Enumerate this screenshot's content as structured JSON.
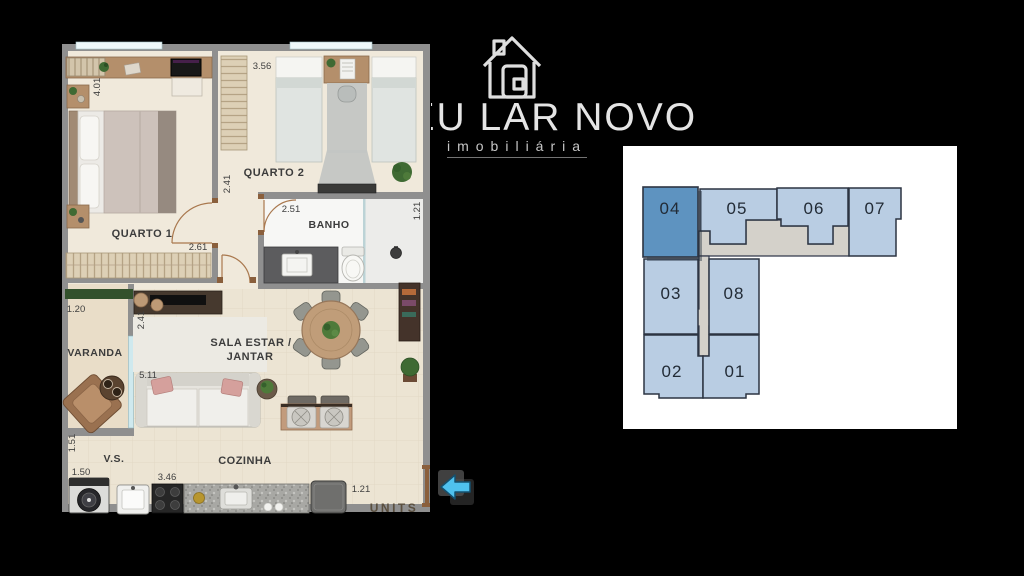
{
  "logo": {
    "name": "MEU LAR NOVO",
    "tagline": "imobiliária",
    "icon": "house-outline-icon"
  },
  "floorplan": {
    "rooms": {
      "quarto1": {
        "label": "QUARTO 1",
        "dim_height": "4.01",
        "dim_width": "2.61"
      },
      "quarto2": {
        "label": "QUARTO 2",
        "dim_width": "3.56"
      },
      "hall": {
        "dim_width": "2.41"
      },
      "banho": {
        "label": "BANHO",
        "dim_width": "2.51",
        "dim_height": "1.21"
      },
      "varanda": {
        "label": "VARANDA",
        "dim_width": "1.20"
      },
      "sala": {
        "label_line1": "SALA ESTAR /",
        "label_line2": "JANTAR",
        "dim_height": "2.41",
        "dim_width": "5.11"
      },
      "vs": {
        "label": "V.S.",
        "dim_height": "1.51",
        "dim_width": "1.50"
      },
      "cozinha": {
        "label": "COZINHA",
        "dim_width": "3.46",
        "dim_depth": "1.21"
      }
    },
    "watermark": "UNITS"
  },
  "unit_map": {
    "highlighted_unit": "04",
    "units": [
      {
        "number": "04",
        "highlighted": true
      },
      {
        "number": "05",
        "highlighted": false
      },
      {
        "number": "06",
        "highlighted": false
      },
      {
        "number": "07",
        "highlighted": false
      },
      {
        "number": "03",
        "highlighted": false
      },
      {
        "number": "08",
        "highlighted": false
      },
      {
        "number": "02",
        "highlighted": false
      },
      {
        "number": "01",
        "highlighted": false
      }
    ],
    "colors": {
      "unit_fill": "#b9cde3",
      "highlight_fill": "#5e93c0",
      "corridor_fill": "#d4d1ca",
      "outline": "#2c3442",
      "panel_bg": "#ffffff"
    }
  },
  "nav": {
    "back_arrow_color": "#4fc1ee"
  }
}
